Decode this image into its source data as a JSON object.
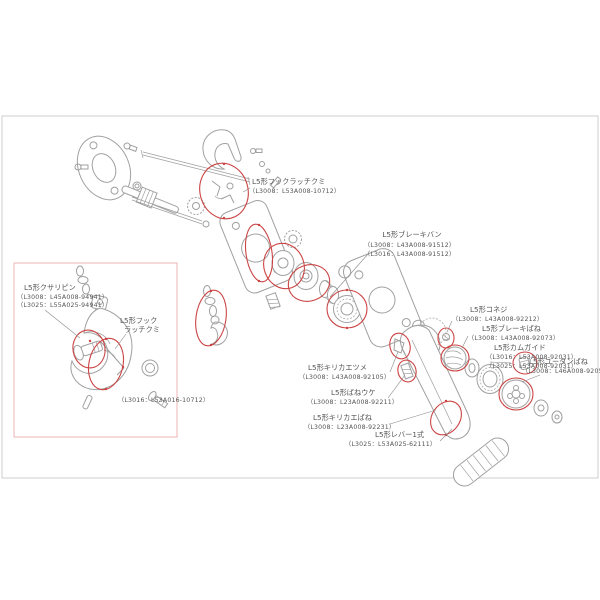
{
  "colors": {
    "background": "#ffffff",
    "frame_border": "#cccccc",
    "inset_box_border": "#eeb4b4",
    "highlight": "#cc4444",
    "line_art": "#a0a0a0",
    "label_text": "#555555"
  },
  "diagram_subject": "L5形 レバーブロック 分解部品図",
  "labels": {
    "hook_latch_top": {
      "name": "L5形フックラッチクミ",
      "part_numbers": [
        "（L3008：L53A008-10712）"
      ]
    },
    "brake_band": {
      "name": "L5形ブレーキバン",
      "part_numbers": [
        "（L3008：L43A008-91512）",
        "（L3016：L43A008-91512）"
      ]
    },
    "chain_pin": {
      "name": "L5形クサリピン",
      "part_numbers": [
        "（L3008：L45A008-94941）",
        "（L3025：L55A025-94941）"
      ]
    },
    "hook_latch_box": {
      "name_line1": "L5形フック",
      "name_line2": "ラッチクミ",
      "part_numbers": [
        "（L3016：L53A016-10712）"
      ]
    },
    "switch_pawl": {
      "name": "L5形キリカエツメ",
      "part_numbers": [
        "（L3008：L43A008-92105）"
      ]
    },
    "spring_seat": {
      "name": "L5形ばねウケ",
      "part_numbers": [
        "（L3008：L23A008-92211）"
      ]
    },
    "switch_spring": {
      "name": "L5形キリカエばね",
      "part_numbers": [
        "（L3008：L23A008-92231）"
      ]
    },
    "lever": {
      "name": "L5形レバー1式",
      "part_numbers": [
        "（L3025：L53A025-62111）"
      ]
    },
    "small_screw": {
      "name": "L5形コネジ",
      "part_numbers": [
        "（L3008：L43A008-92212）"
      ]
    },
    "brake_spring": {
      "name": "L5形ブレーキばね",
      "part_numbers": [
        "（L3008：L43A008-92073）"
      ]
    },
    "cam_guide": {
      "name": "L5形カムガイド",
      "part_numbers": [
        "（L3016：L53A008-92031）",
        "（L3025：L53A008-92031）"
      ]
    },
    "u_turn_spring": {
      "name": "L5形ユータンばね",
      "part_numbers": [
        "（L3008：L46A008-92052）"
      ]
    }
  }
}
